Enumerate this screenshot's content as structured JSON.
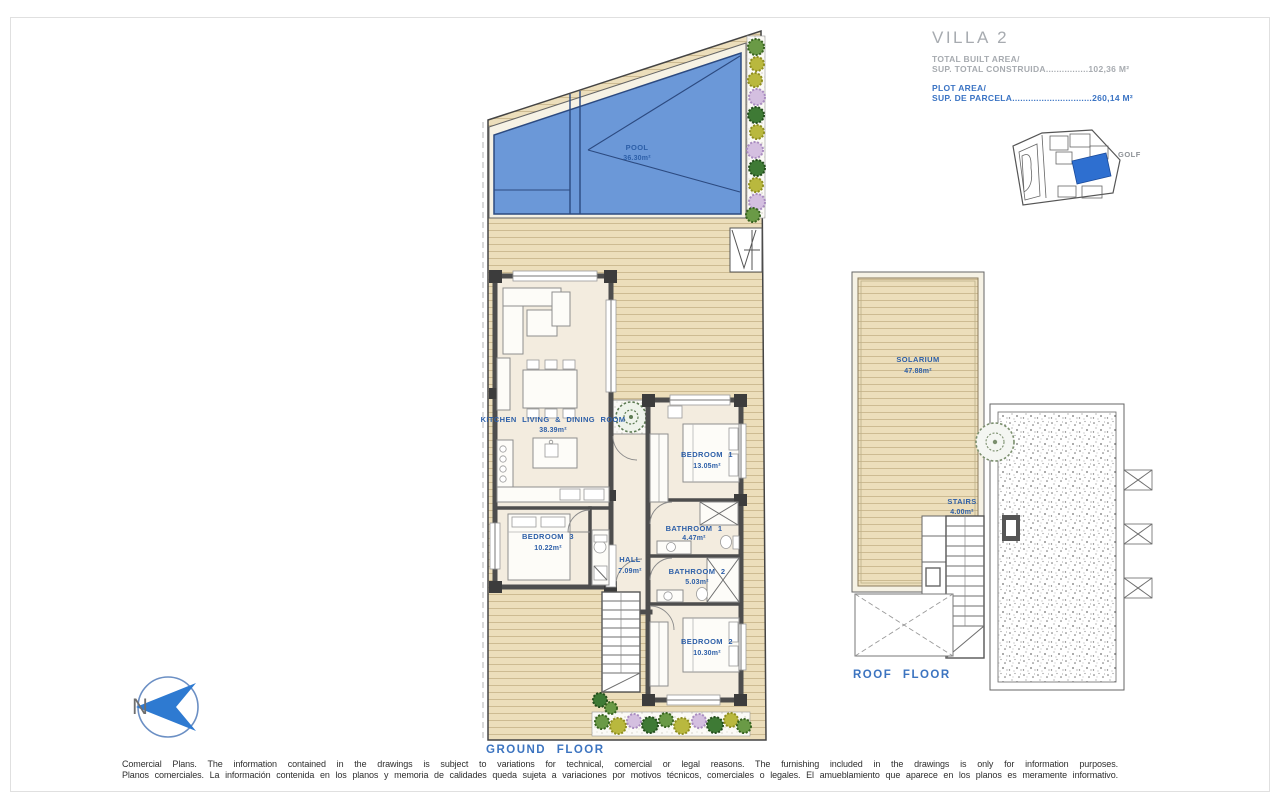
{
  "title_block": {
    "villa": "VILLA 2",
    "built_area_label": "TOTAL BUILT AREA/",
    "built_area_line": "SUP. TOTAL CONSTRUIDA................102,36 M²",
    "plot_area_label": "PLOT AREA/",
    "plot_area_line": "SUP. DE PARCELA..............................260,14 M²"
  },
  "site_plan": {
    "golf": "GOLF"
  },
  "ground_floor": {
    "caption": "GROUND FLOOR",
    "north": "N",
    "pool": {
      "name": "POOL",
      "area": "36.30m²"
    },
    "kitchen": {
      "name": "KITCHEN LIVING & DINING ROOM",
      "area": "38.39m²"
    },
    "bedroom1": {
      "name": "BEDROOM 1",
      "area": "13.05m²"
    },
    "bedroom2": {
      "name": "BEDROOM 2",
      "area": "10.30m²"
    },
    "bedroom3": {
      "name": "BEDROOM 3",
      "area": "10.22m²"
    },
    "hall": {
      "name": "HALL",
      "area": "7.09m²"
    },
    "bathroom1": {
      "name": "BATHROOM 1",
      "area": "4.47m²"
    },
    "bathroom2": {
      "name": "BATHROOM 2",
      "area": "5.03m²"
    }
  },
  "roof_floor": {
    "caption": "ROOF FLOOR",
    "solarium": {
      "name": "SOLARIUM",
      "area": "47.88m²"
    },
    "stairs": {
      "name": "STAIRS",
      "area": "4.00m²"
    }
  },
  "disclaimer": {
    "en": "Comercial Plans. The information contained in the drawings is subject to variations for technical, comercial or legal reasons. The furnishing included in the drawings is only for information purposes.",
    "es": "Planos comerciales. La información contenida en los planos y memoria de calidades queda sujeta a variaciones por motivos técnicos, comerciales o legales. El amueblamiento que aparece en los planos es meramente informativo."
  },
  "colors": {
    "pool_blue": "#6b98d8",
    "deck_tan": "#ecdebb",
    "label_blue": "#2d5fa8",
    "accent_blue": "#3b74c4",
    "title_gray": "#a7abb0"
  }
}
